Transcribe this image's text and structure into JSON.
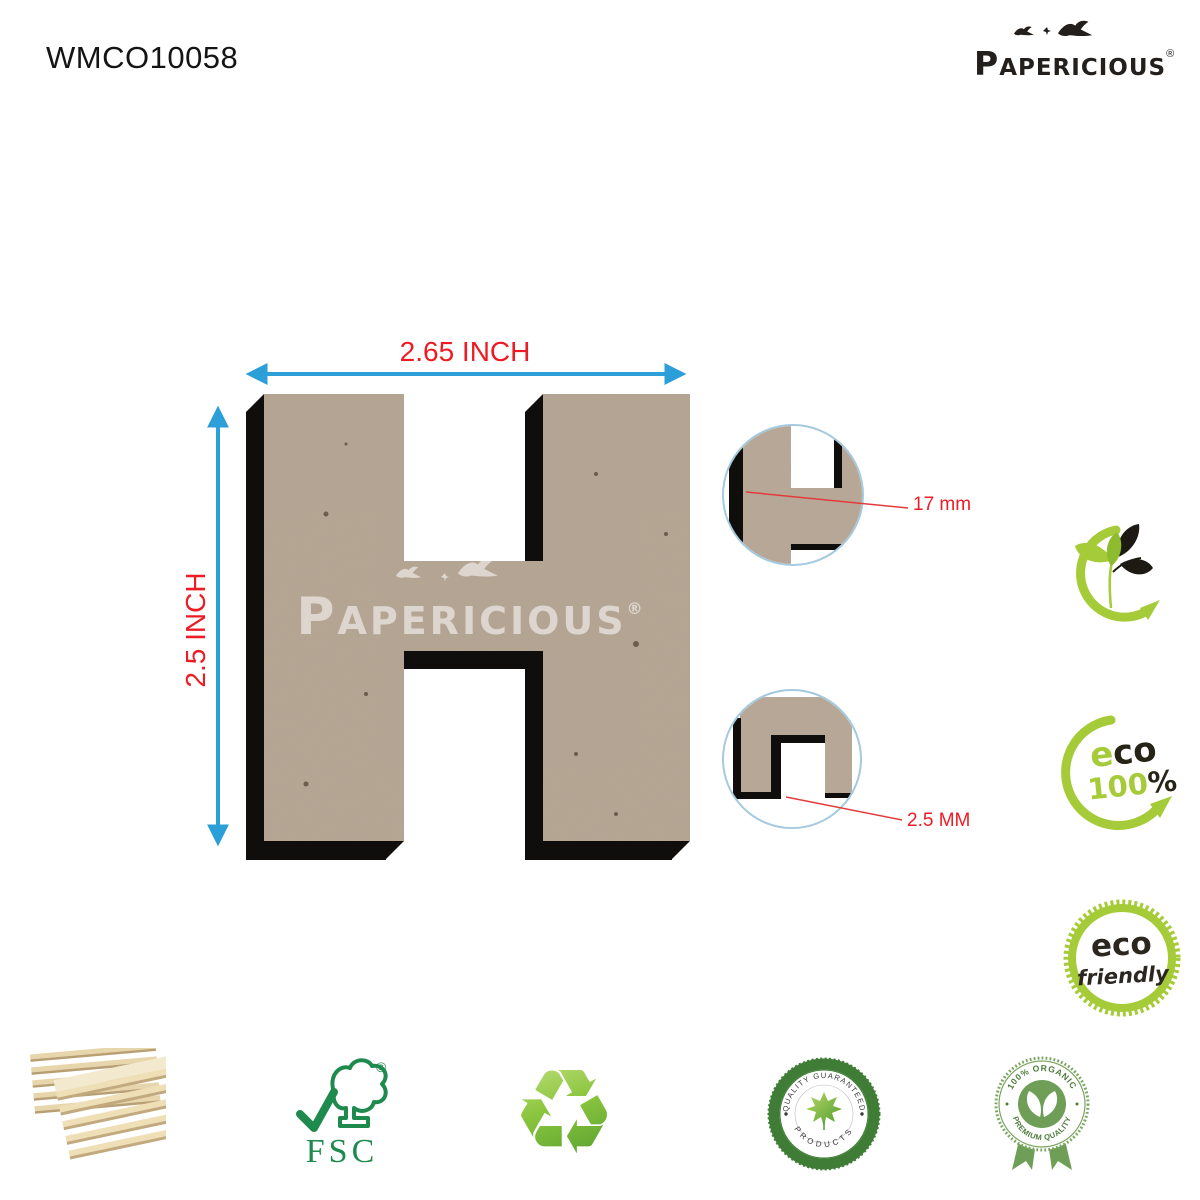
{
  "header": {
    "product_code": "WMCO10058"
  },
  "brand": {
    "initial": "P",
    "rest": "APERICIOUS",
    "registered": "®"
  },
  "product": {
    "letter": "H",
    "watermark_initial": "P",
    "watermark_rest": "APERICIOUS",
    "watermark_registered": "®",
    "material_color": "#b6a593",
    "shadow_color": "#0f0e0c"
  },
  "dimensions": {
    "width_label": "2.65 INCH",
    "height_label": "2.5 INCH",
    "thickness_label": "17 mm",
    "edge_label": "2.5 MM",
    "arrow_color": "#2d9fd8",
    "label_color": "#ed1c24"
  },
  "eco": {
    "stamp100": {
      "e": "e",
      "co": "co",
      "num": "100",
      "pct": "%"
    },
    "friendly": {
      "line1": "eco",
      "line2": "friendly"
    },
    "green": "#a6cb39"
  },
  "badges": {
    "fsc": {
      "label": "FSC",
      "copyright": "©",
      "green": "#1f8a4d"
    },
    "quality": {
      "top": "QUALITY GUARANTEED",
      "bottom": "PRODUCTS"
    },
    "organic": {
      "top": "100% ORGANIC",
      "bottom": "PREMIUM QUALITY"
    }
  },
  "icons": {
    "recycle_glyph": "♻"
  }
}
